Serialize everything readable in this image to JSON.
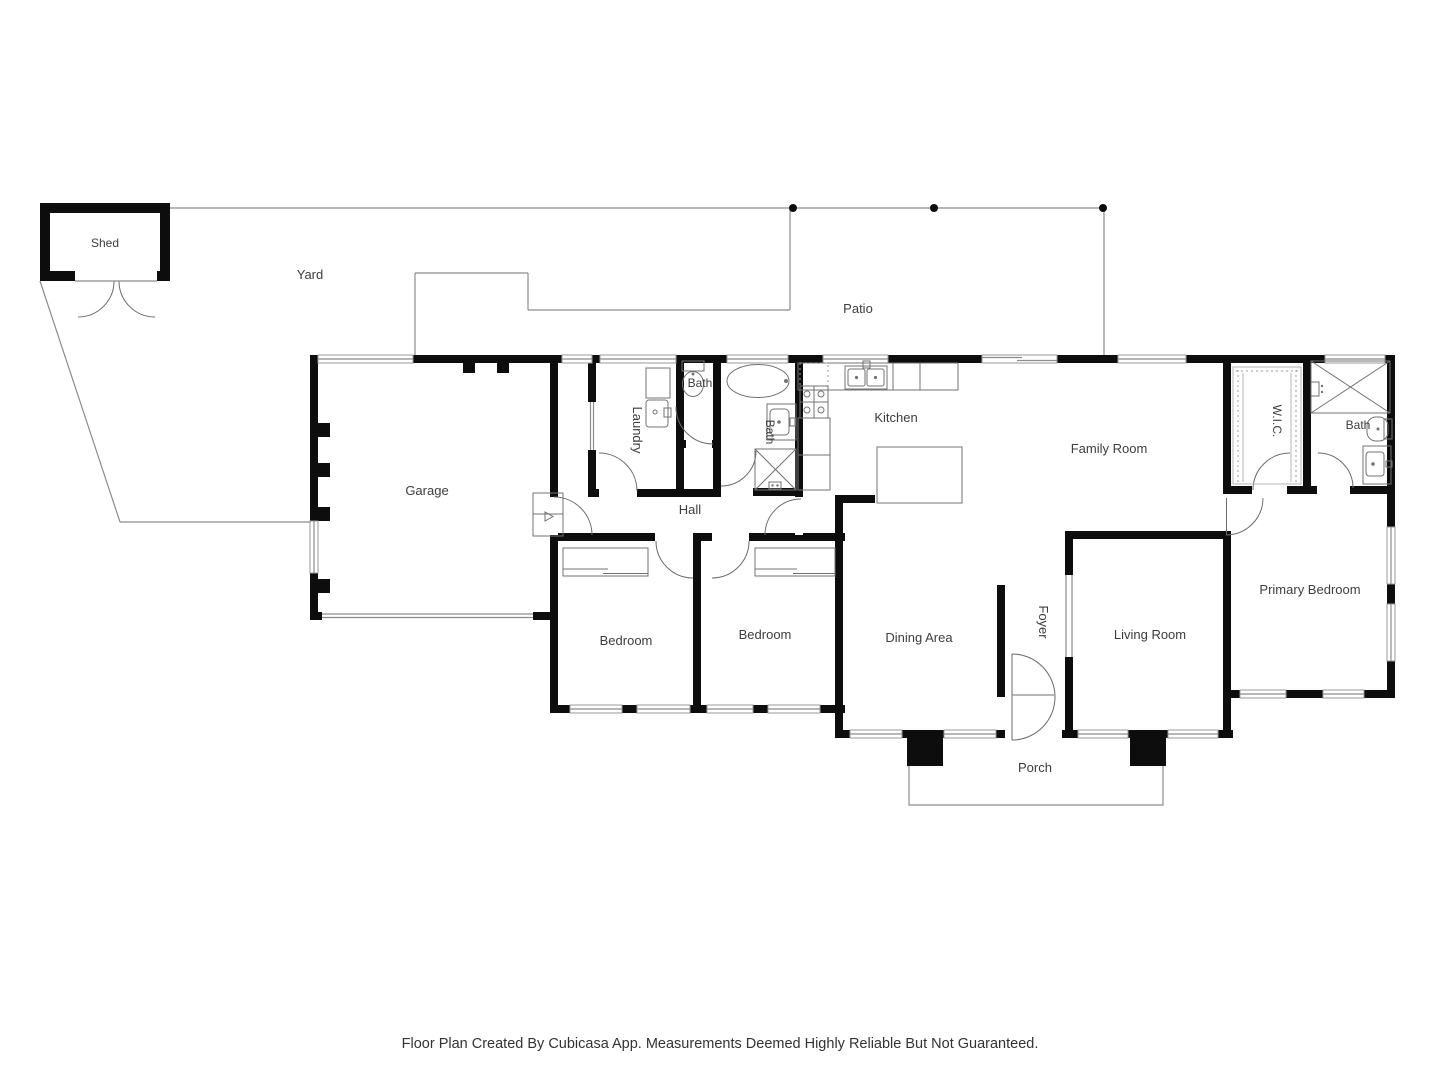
{
  "labels": {
    "shed": "Shed",
    "yard": "Yard",
    "patio": "Patio",
    "garage": "Garage",
    "laundry": "Laundry",
    "bath_laundry": "Bath",
    "bath_hall": "Bath",
    "kitchen": "Kitchen",
    "family_room": "Family Room",
    "wic": "W.I.C.",
    "bath_primary": "Bath",
    "hall": "Hall",
    "bedroom_1": "Bedroom",
    "bedroom_2": "Bedroom",
    "dining_area": "Dining Area",
    "foyer": "Foyer",
    "living_room": "Living Room",
    "primary_bedroom": "Primary Bedroom",
    "porch": "Porch"
  },
  "footer": {
    "disclaimer": "Floor Plan Created By Cubicasa App. Measurements Deemed Highly Reliable But Not Guaranteed."
  },
  "colors": {
    "wall": "#0d0d0d",
    "boundary_line": "#8c8c8c",
    "fixture_line": "#737373",
    "text": "#3d3d3d",
    "background": "#ffffff"
  }
}
